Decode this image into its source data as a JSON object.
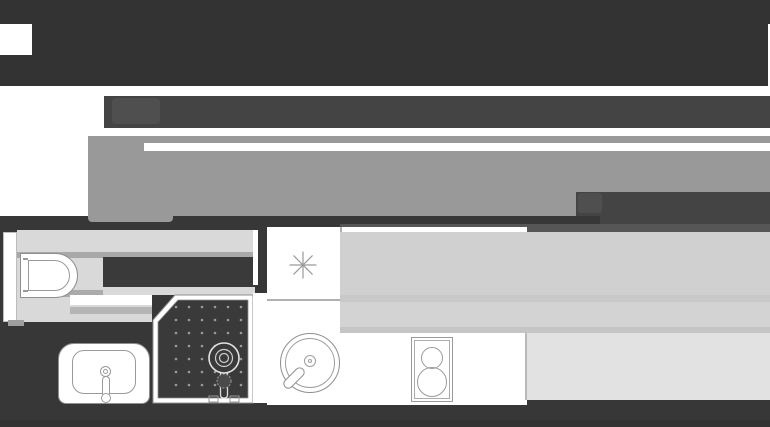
{
  "page": {
    "kind": "grayscale real-estate page mock with studio floor plan",
    "has_text": false
  },
  "palette": {
    "header_bg": "#333333",
    "skeleton_bar_bg": "#444444",
    "skeleton_gray": "#999999",
    "shadow_band": "#565656",
    "plan_band_bg": "#373737",
    "bath_light": "#d9d9d9",
    "bath_stripe": "#a9a9a9",
    "bath_dark_block": "#3a3a3a",
    "counter_gray": "#d0d0d0",
    "counter_gray_2": "#d3d3d3",
    "counter_light": "#e2e2e2",
    "fixture_line": "#8f8f8f",
    "white": "#ffffff"
  },
  "header": {
    "logo_placeholder": "white-square",
    "edge_notch": "white-sliver"
  },
  "skeleton": {
    "nav_bar": "dark horizontal bar with faint watermark",
    "title_bar": "thin gray bar",
    "hero": "large gray image placeholder",
    "caption_block": "dark block with faint watermark",
    "footer_tab": "small rounded gray tab"
  },
  "floorplan": {
    "rooms": [
      {
        "name": "bathroom",
        "fixtures": [
          "toilet",
          "washbasin",
          "corner-shower"
        ]
      },
      {
        "name": "kitchen",
        "fixtures": [
          "appliance-star",
          "round-sink",
          "two-burner-cooktop",
          "counter"
        ]
      }
    ],
    "shower_dots": {
      "cols": [
        176,
        189,
        202,
        215,
        228,
        241
      ],
      "rows": [
        307,
        320,
        333,
        346,
        359,
        372,
        385
      ],
      "radius": 1.3,
      "color": "#9a9a9a"
    }
  }
}
